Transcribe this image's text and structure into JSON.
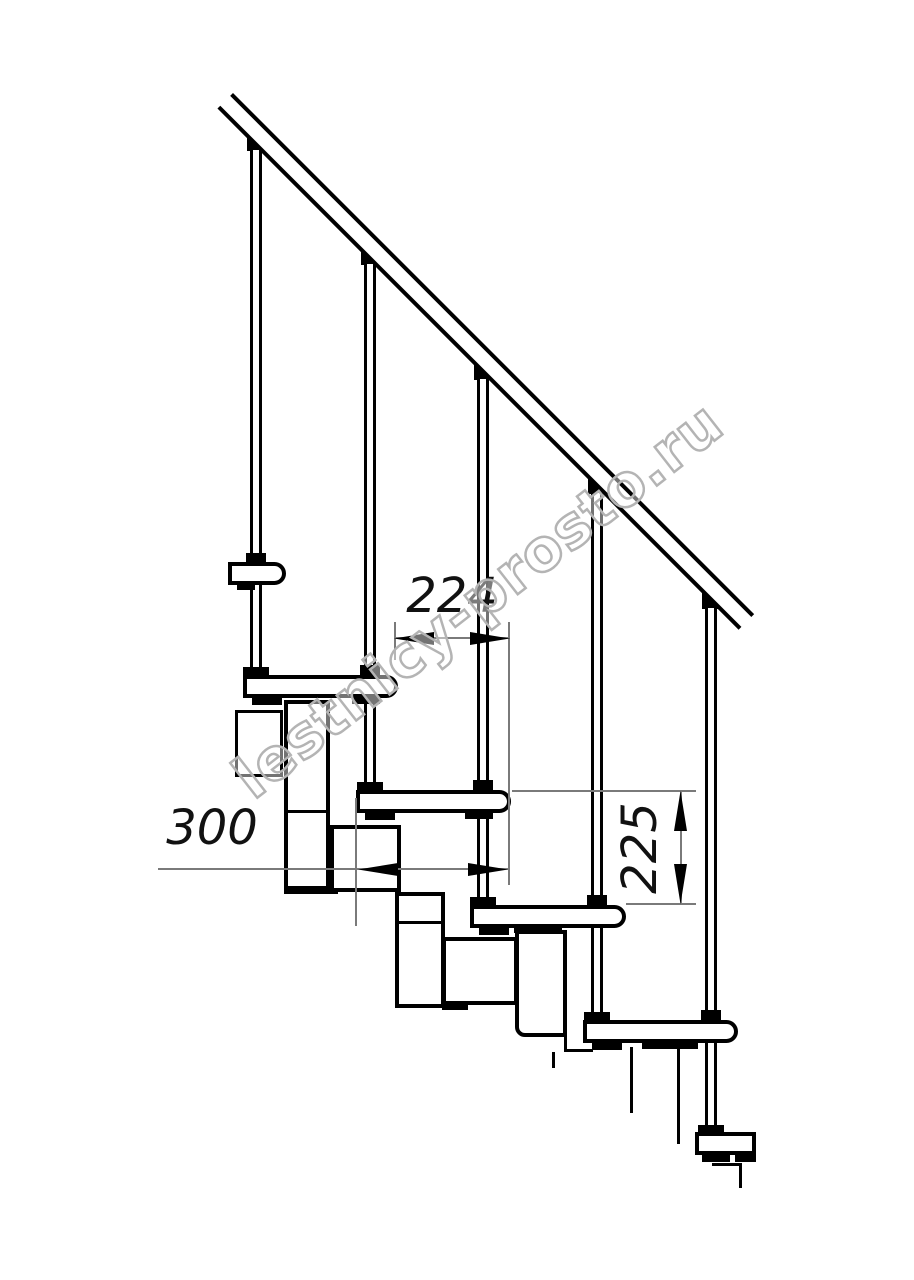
{
  "drawing": {
    "title": "modular staircase side-section technical drawing",
    "watermark": {
      "text": "lestnicy-prosto.ru"
    },
    "dimensions": {
      "run": {
        "label": "224",
        "orientation": "horizontal",
        "meaning": "step run between tread noses"
      },
      "depth": {
        "label": "300",
        "orientation": "horizontal",
        "meaning": "tread depth"
      },
      "rise": {
        "label": "225",
        "orientation": "vertical",
        "meaning": "riser height between treads"
      }
    },
    "colors": {
      "ink": "#000000",
      "dimension_lines": "#7a7a7a",
      "watermark": "#b4b4b4",
      "background": "#ffffff"
    }
  }
}
